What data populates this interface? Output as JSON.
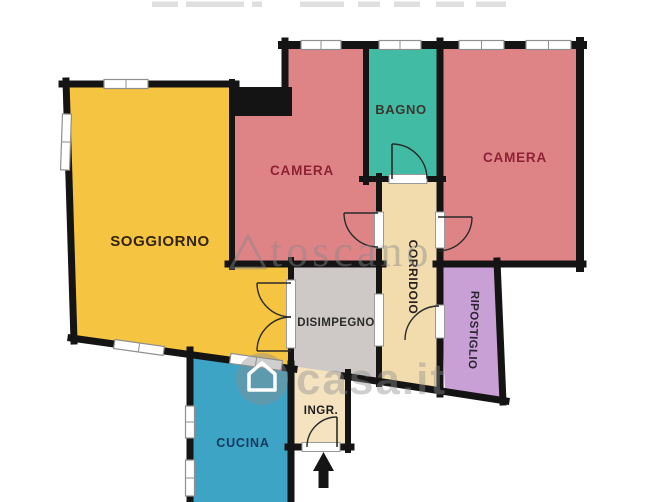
{
  "canvas": {
    "w": 670,
    "h": 502,
    "bg": "#ffffff",
    "wall_color": "#141414",
    "door_stroke": "#2a2a2a"
  },
  "watermarks": {
    "agency": {
      "text": "toscano",
      "x": 270,
      "y": 266,
      "size": 44,
      "letter_spacing": 4,
      "color": "rgba(135,135,135,0.45)",
      "logo_triangle": "M 248,236 L 231,268 L 265,268 Z"
    },
    "portal": {
      "text": "casa.it",
      "x": 296,
      "y": 394,
      "size": 44,
      "letter_spacing": 2,
      "color": "rgba(140,140,140,0.42)",
      "icon_circle": {
        "cx": 262,
        "cy": 379,
        "r": 26
      },
      "icon_house": "M 249,390 L 249,374 L 262,363 L 275,374 L 275,390 Z"
    }
  },
  "top_smudges": {
    "color": "#d9d9d9",
    "segments": [
      {
        "x": 152,
        "w": 26
      },
      {
        "x": 186,
        "w": 58
      },
      {
        "x": 252,
        "w": 10
      },
      {
        "x": 300,
        "w": 44
      },
      {
        "x": 358,
        "w": 22
      },
      {
        "x": 394,
        "w": 26
      },
      {
        "x": 436,
        "w": 28
      },
      {
        "x": 476,
        "w": 30
      }
    ]
  },
  "rooms": [
    {
      "id": "soggiorno",
      "points": "66,84 232,84 232,264 291,264 291,368 73,338",
      "fill": "#f5c441",
      "label": {
        "text": "SOGGIORNO",
        "x": 160,
        "y": 246,
        "size": 15,
        "color": "#33240f",
        "rotate": 0,
        "ls": 0.6
      }
    },
    {
      "id": "camera-1",
      "points": "285,45 366,45 366,179 379,179 379,264 232,264 232,101 285,101",
      "fill": "#de8487",
      "label": {
        "text": "CAMERA",
        "x": 302,
        "y": 175,
        "size": 13.5,
        "color": "#8e2133",
        "rotate": 0,
        "ls": 0.8
      }
    },
    {
      "id": "bagno",
      "points": "366,45 440,45 440,179 366,179",
      "fill": "#41bba3",
      "label": {
        "text": "BAGNO",
        "x": 401,
        "y": 114,
        "size": 13,
        "color": "#3a362e",
        "rotate": 0,
        "ls": 0.6
      }
    },
    {
      "id": "camera-2",
      "points": "440,45 580,45 580,264 440,264",
      "fill": "#de8487",
      "label": {
        "text": "CAMERA",
        "x": 515,
        "y": 162,
        "size": 13.5,
        "color": "#8e2133",
        "rotate": 0,
        "ls": 0.8
      }
    },
    {
      "id": "corridoio",
      "points": "379,179 440,179 440,390 379,381",
      "fill": "#f2dcae",
      "label": {
        "text": "CORRIDOIO",
        "x": 409,
        "y": 277,
        "size": 12,
        "color": "#26211c",
        "rotate": 90,
        "ls": 0.6
      }
    },
    {
      "id": "ripostiglio",
      "points": "440,265 497,265 503,399 445,391",
      "fill": "#c9a0d6",
      "label": {
        "text": "RIPOSTIGLIO",
        "x": 470,
        "y": 330,
        "size": 11.5,
        "color": "#2a2530",
        "rotate": 92,
        "ls": 0.4
      }
    },
    {
      "id": "disimpegno",
      "points": "291,264 379,264 379,381 291,368",
      "fill": "#cec9c7",
      "label": {
        "text": "DISIMPEGNO",
        "x": 336,
        "y": 326,
        "size": 11.5,
        "color": "#2b2b2b",
        "rotate": 0,
        "ls": 0.4
      }
    },
    {
      "id": "ingresso",
      "points": "291,366 348,374 348,447 291,447",
      "fill": "#f5e3c0",
      "label": {
        "text": "INGR.",
        "x": 321,
        "y": 414,
        "size": 11.5,
        "color": "#1d1d1d",
        "rotate": 0,
        "ls": 0.5
      }
    },
    {
      "id": "cucina",
      "points": "190,352 291,367 291,502 190,502",
      "fill": "#3da4c6",
      "label": {
        "text": "CUCINA",
        "x": 243,
        "y": 447,
        "size": 12.5,
        "color": "#123a5e",
        "rotate": 0,
        "ls": 0.8
      }
    }
  ],
  "walls": [
    {
      "x1": 62,
      "y1": 84,
      "x2": 236,
      "y2": 84,
      "w": 7
    },
    {
      "x1": 66,
      "y1": 81,
      "x2": 74,
      "y2": 341,
      "w": 7
    },
    {
      "x1": 71,
      "y1": 338,
      "x2": 294,
      "y2": 369,
      "w": 7
    },
    {
      "x1": 282,
      "y1": 45,
      "x2": 583,
      "y2": 45,
      "w": 8
    },
    {
      "x1": 285,
      "y1": 41,
      "x2": 285,
      "y2": 104,
      "w": 7
    },
    {
      "x1": 232,
      "y1": 82,
      "x2": 232,
      "y2": 267,
      "w": 6
    },
    {
      "x1": 228,
      "y1": 264,
      "x2": 383,
      "y2": 264,
      "w": 7
    },
    {
      "x1": 366,
      "y1": 45,
      "x2": 366,
      "y2": 182,
      "w": 6
    },
    {
      "x1": 440,
      "y1": 41,
      "x2": 440,
      "y2": 394,
      "w": 7
    },
    {
      "x1": 362,
      "y1": 179,
      "x2": 443,
      "y2": 179,
      "w": 6
    },
    {
      "x1": 379,
      "y1": 176,
      "x2": 379,
      "y2": 384,
      "w": 6
    },
    {
      "x1": 436,
      "y1": 264,
      "x2": 583,
      "y2": 264,
      "w": 7
    },
    {
      "x1": 580,
      "y1": 41,
      "x2": 580,
      "y2": 268,
      "w": 8
    },
    {
      "x1": 497,
      "y1": 261,
      "x2": 503,
      "y2": 402,
      "w": 7
    },
    {
      "x1": 344,
      "y1": 376,
      "x2": 506,
      "y2": 401,
      "w": 7
    },
    {
      "x1": 291,
      "y1": 260,
      "x2": 291,
      "y2": 371,
      "w": 6
    },
    {
      "x1": 348,
      "y1": 372,
      "x2": 348,
      "y2": 450,
      "w": 6
    },
    {
      "x1": 288,
      "y1": 447,
      "x2": 351,
      "y2": 447,
      "w": 7
    },
    {
      "x1": 291,
      "y1": 364,
      "x2": 291,
      "y2": 502,
      "w": 7
    },
    {
      "x1": 190,
      "y1": 350,
      "x2": 190,
      "y2": 502,
      "w": 7
    }
  ],
  "wall_blocks": [
    {
      "x": 229,
      "y": 87,
      "w": 63,
      "h": 29
    }
  ],
  "windows": [
    {
      "x": 104,
      "y": 79.5,
      "w": 44,
      "h": 9,
      "r": 0
    },
    {
      "x": 61.5,
      "y": 114,
      "w": 9,
      "h": 56,
      "r": 2
    },
    {
      "x": 301,
      "y": 40.5,
      "w": 40,
      "h": 9,
      "r": 0
    },
    {
      "x": 379,
      "y": 40.5,
      "w": 42,
      "h": 9,
      "r": 0
    },
    {
      "x": 459,
      "y": 40.5,
      "w": 45,
      "h": 9,
      "r": 0
    },
    {
      "x": 526,
      "y": 40.5,
      "w": 45,
      "h": 9,
      "r": 0
    },
    {
      "x": 114,
      "y": 343,
      "w": 50,
      "h": 9,
      "r": 8
    },
    {
      "x": 230,
      "y": 357,
      "w": 52,
      "h": 10,
      "r": 8
    },
    {
      "x": 185.5,
      "y": 406,
      "w": 9,
      "h": 32,
      "r": 0
    },
    {
      "x": 185.5,
      "y": 460,
      "w": 9,
      "h": 36,
      "r": 0
    }
  ],
  "thresholds": [
    {
      "x": 389,
      "y": 174.5,
      "w": 38,
      "h": 9
    },
    {
      "x": 374.5,
      "y": 212,
      "w": 9,
      "h": 36
    },
    {
      "x": 435.5,
      "y": 212,
      "w": 9,
      "h": 36
    },
    {
      "x": 435.5,
      "y": 305,
      "w": 9,
      "h": 33
    },
    {
      "x": 374.5,
      "y": 294,
      "w": 9,
      "h": 52
    },
    {
      "x": 286.5,
      "y": 280,
      "w": 9,
      "h": 68
    },
    {
      "x": 302,
      "y": 442.5,
      "w": 38,
      "h": 9
    }
  ],
  "doors": [
    {
      "arc": "M 427,179 A 35,35 0 0 0 392,144",
      "leaf": "M 392,179 L 392,144"
    },
    {
      "arc": "M 378,247 A 34,34 0 0 1 344,213",
      "leaf": "M 378,213 L 344,213"
    },
    {
      "arc": "M 472,217 A 34,34 0 0 1 438,251",
      "leaf": "M 438,217 L 472,217"
    },
    {
      "arc": "M 439,306 A 34,34 0 0 0 405,340",
      "leaf": ""
    },
    {
      "arc": "M 257,283 A 34,34 0 0 0 291,317",
      "leaf": "M 291,283 L 257,283"
    },
    {
      "arc": "M 257,351 A 34,34 0 0 1 291,317",
      "leaf": "M 291,351 L 257,351"
    },
    {
      "arc": "M 337,417 A 30,30 0 0 0 307,447",
      "leaf": "M 337,447 L 337,417"
    }
  ],
  "entrance_arrow": {
    "points": "323.5,452 334,471 328.5,471 328.5,488 318.5,488 318.5,471 313,471",
    "color": "#151515"
  }
}
